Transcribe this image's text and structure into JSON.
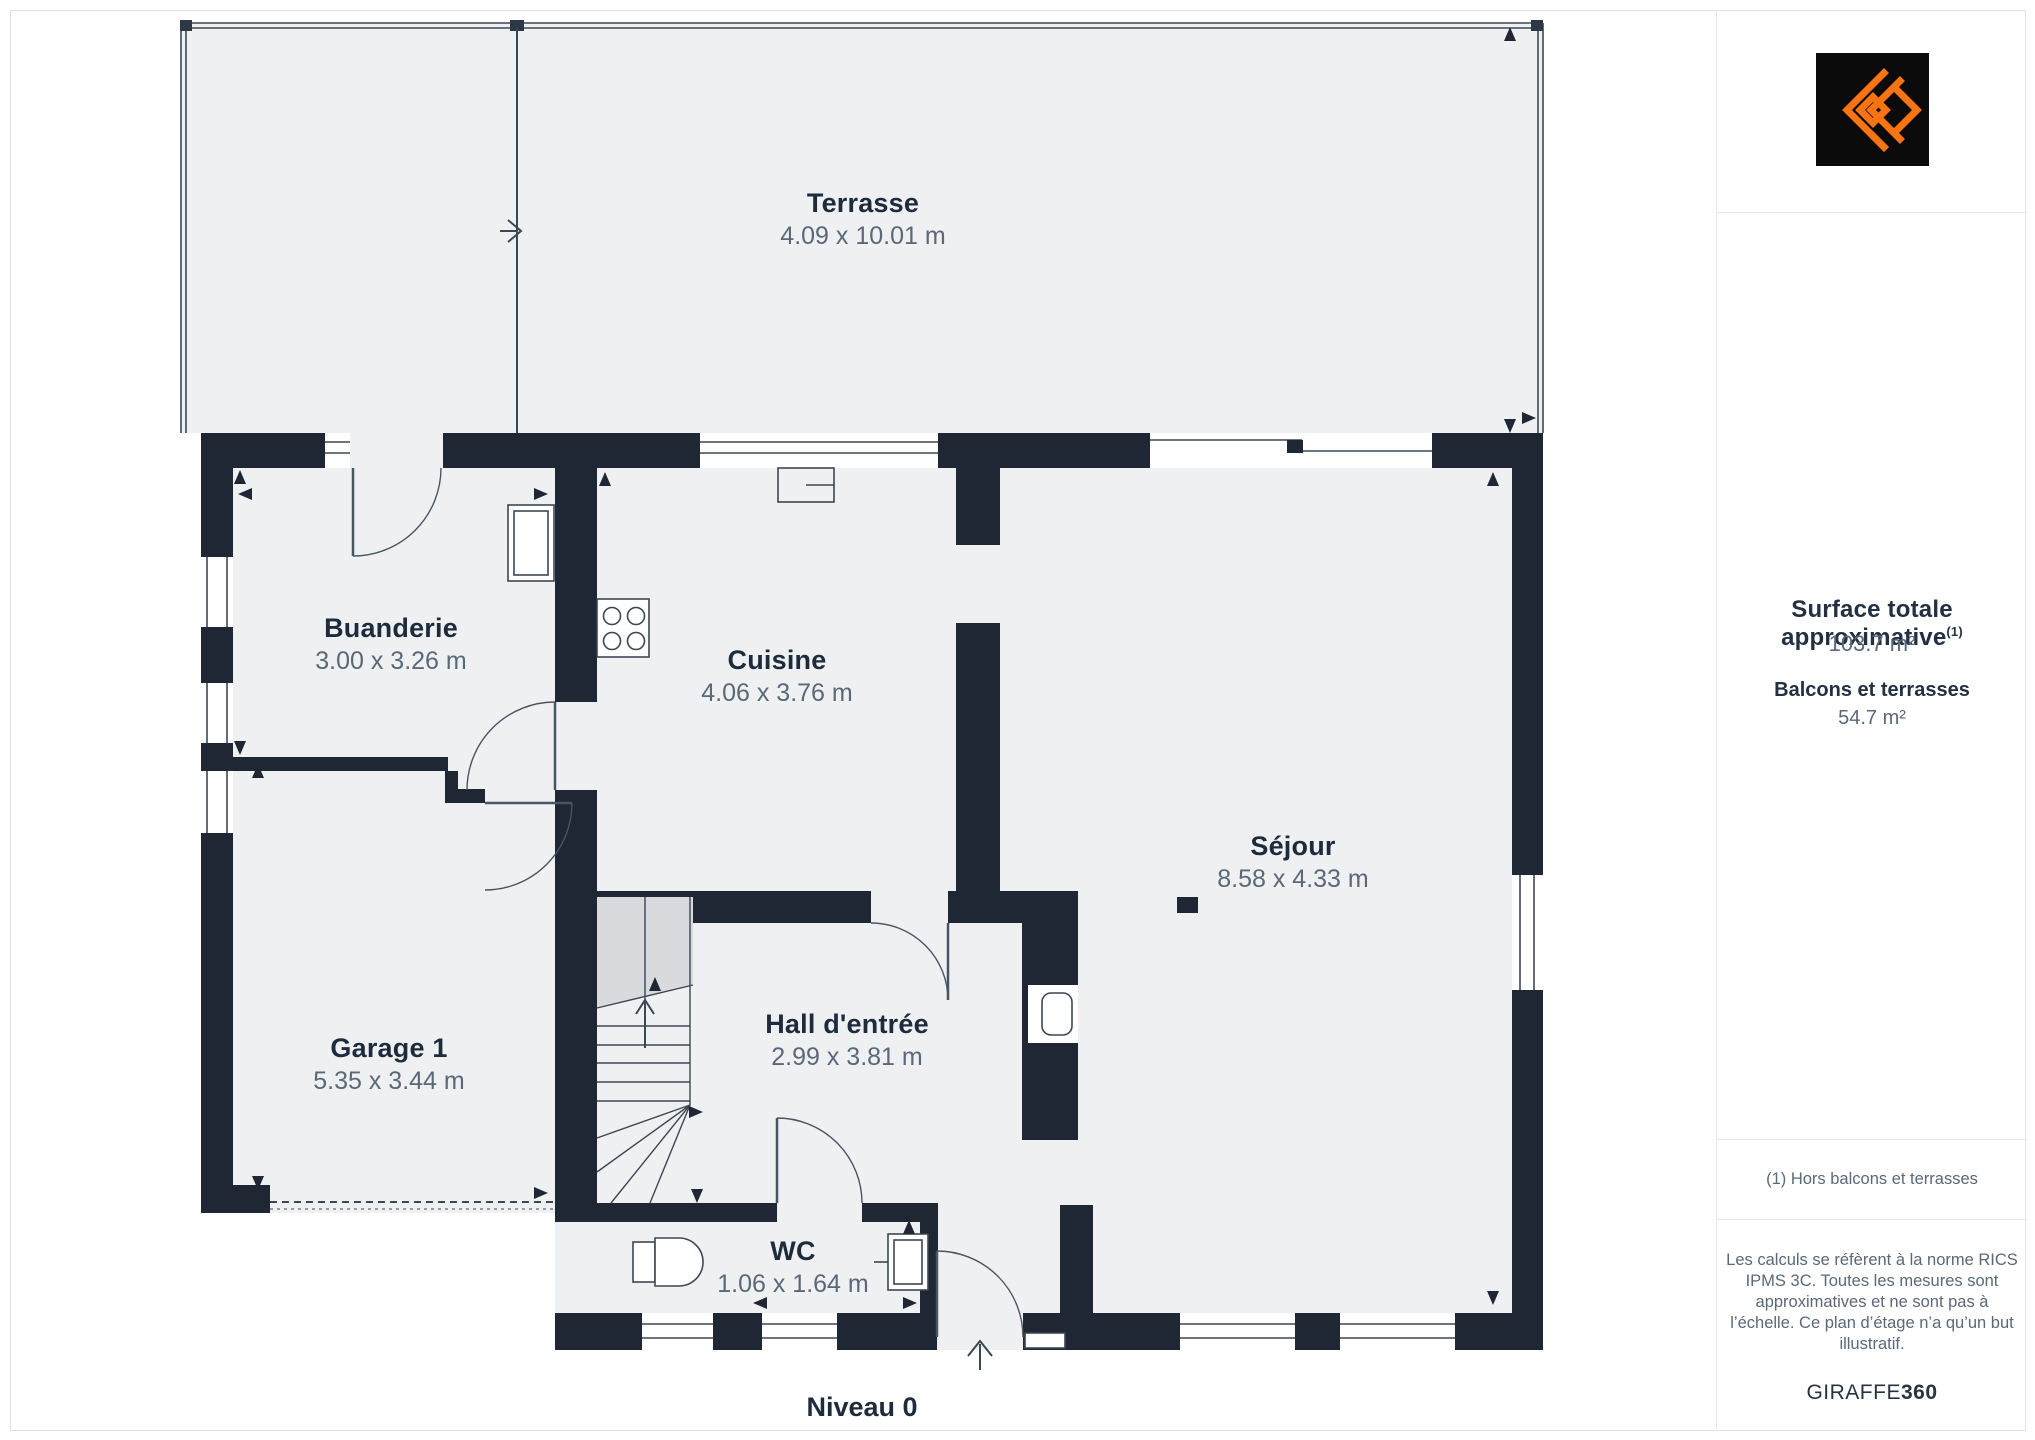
{
  "floorplan": {
    "level_label": "Niveau 0",
    "rooms": {
      "terrasse": {
        "name": "Terrasse",
        "dims": "4.09 x 10.01 m"
      },
      "buanderie": {
        "name": "Buanderie",
        "dims": "3.00 x 3.26 m"
      },
      "cuisine": {
        "name": "Cuisine",
        "dims": "4.06 x 3.76 m"
      },
      "sejour": {
        "name": "Séjour",
        "dims": "8.58 x 4.33 m"
      },
      "garage": {
        "name": "Garage 1",
        "dims": "5.35 x 3.44 m"
      },
      "hall": {
        "name": "Hall d'entrée",
        "dims": "2.99 x 3.81 m"
      },
      "wc": {
        "name": "WC",
        "dims": "1.06 x 1.64 m"
      }
    }
  },
  "sidebar": {
    "surface_title": "Surface totale approximative",
    "surface_title_sup": "(1)",
    "surface_value": "103.7 m²",
    "balconies_title": "Balcons et terrasses",
    "balconies_value": "54.7 m²",
    "footnote": "(1) Hors balcons et terrasses",
    "disclaimer": "Les calculs se réfèrent à la norme RICS IPMS 3C. Toutes les mesures sont approximatives et ne sont pas à l’échelle. Ce plan d’étage n’a qu’un but illustratif.",
    "brand_regular": "GIRAFFE",
    "brand_bold": "360"
  },
  "colors": {
    "wall_dark": "#1e2733",
    "room_fill": "#eff0f2",
    "stair_shade": "#d8dade",
    "logo_orange": "#f87412",
    "logo_black": "#0b0b0b",
    "dim_text": "#5a6878"
  }
}
